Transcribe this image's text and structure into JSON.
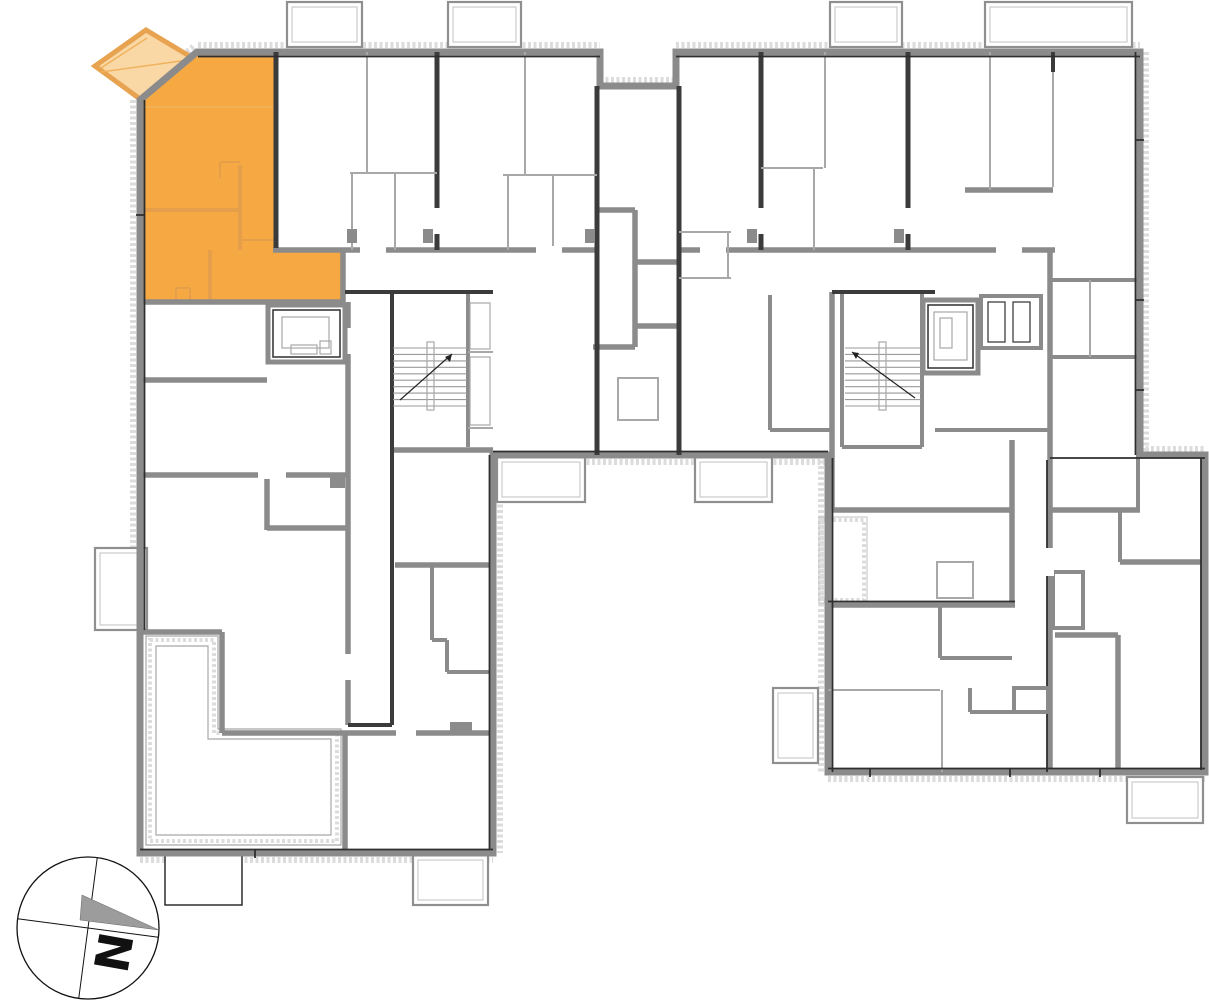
{
  "app": {
    "kind": "apartment-floor-plan-viewer"
  },
  "floor_plan": {
    "selected_unit": {
      "id": "top-left-apartment",
      "state": "selected",
      "fill": "#F6A843",
      "interior_wall_color": "#E59E49",
      "balcony_fill": "#FAD8A5",
      "balcony_stroke": "#E8A351"
    },
    "colors": {
      "background": "#FFFFFF",
      "wall": "#8B8B8B",
      "wall_dark": "#3B3B3B",
      "wall_darkest": "#2F2F2F",
      "wall_thin": "#A8A8A8",
      "hatch": "#DCDCDC",
      "balcony_outline": "#8F8F8F",
      "balcony_inner_outline": "#C0C0C0",
      "compass_ink": "#111111",
      "compass_needle": "#9C9C9C"
    },
    "compass": {
      "label": "N",
      "bearing_deg": 100
    }
  }
}
